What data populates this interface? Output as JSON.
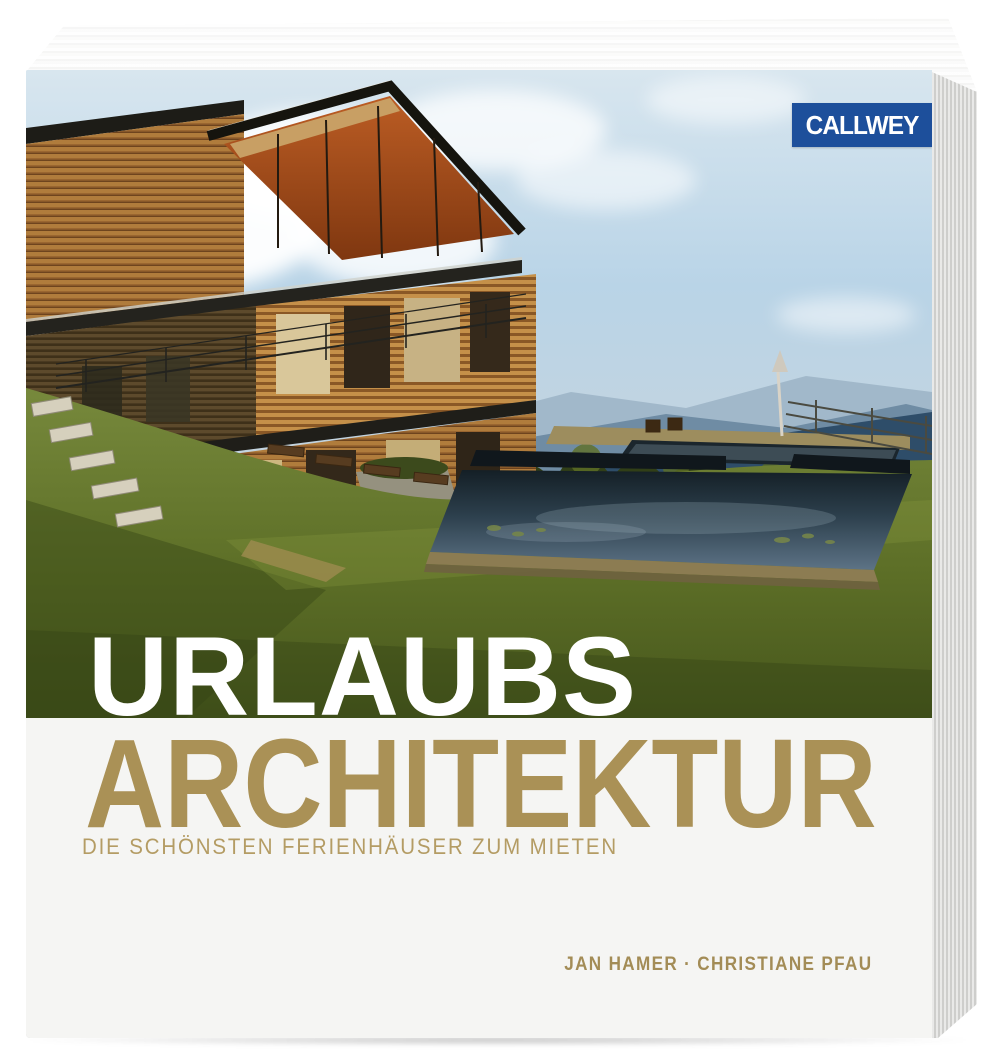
{
  "book": {
    "publisher": "CALLWEY",
    "title_line_1": "URLAUBS",
    "title_line_2": "ARCHITEKTUR",
    "subtitle": "DIE SCHÖNSTEN FERIENHÄUSER ZUM MIETEN",
    "authors": "JAN HAMER · CHRISTIANE PFAU"
  },
  "colors": {
    "publisher_blue": "#1d4f9b",
    "title_line_1_color": "#ffffff",
    "title_line_2_color": "#aa9156",
    "subtitle_color": "#b49c64",
    "authors_color": "#a38c56",
    "cover_band": "#f5f5f3"
  }
}
